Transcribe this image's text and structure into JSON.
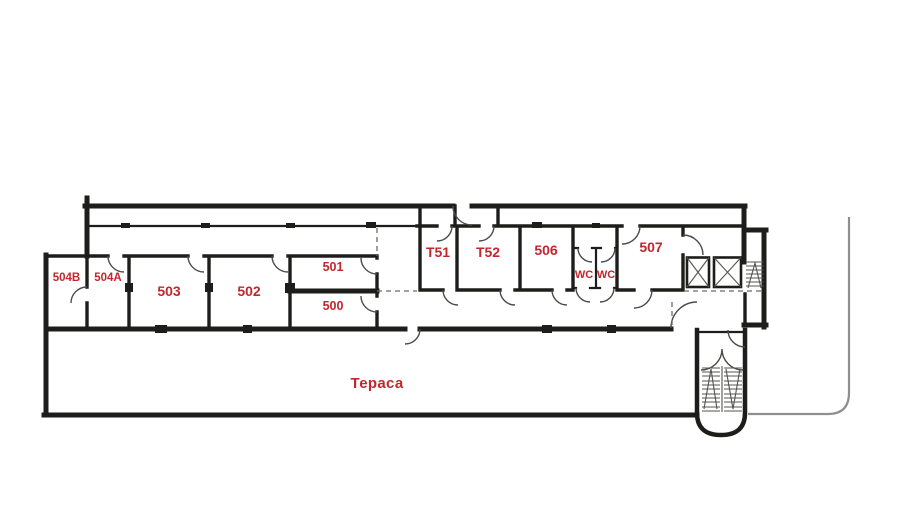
{
  "document": {
    "type": "floor-plan-drawing",
    "background": "#ffffff"
  },
  "colors": {
    "background": "#ffffff",
    "room_label": "#c1272d",
    "wall": "#1d1d1b",
    "door_arc": "#4a4a48",
    "dashed_guide": "#6b6b69",
    "stair_detail": "#55544f",
    "boundary_line": "#8f8f8f"
  },
  "rooms": [
    {
      "label": "504B"
    },
    {
      "label": "504A"
    },
    {
      "label": "503"
    },
    {
      "label": "502"
    },
    {
      "label": "501"
    },
    {
      "label": "500"
    },
    {
      "label": "T51"
    },
    {
      "label": "T52"
    },
    {
      "label": "506"
    },
    {
      "label": "WC"
    },
    {
      "label": "WC"
    },
    {
      "label": "507"
    }
  ],
  "terrace": {
    "label": "Тераса"
  },
  "features": {
    "elevator_shafts": 2,
    "staircases": 2,
    "wc_count": 2
  }
}
